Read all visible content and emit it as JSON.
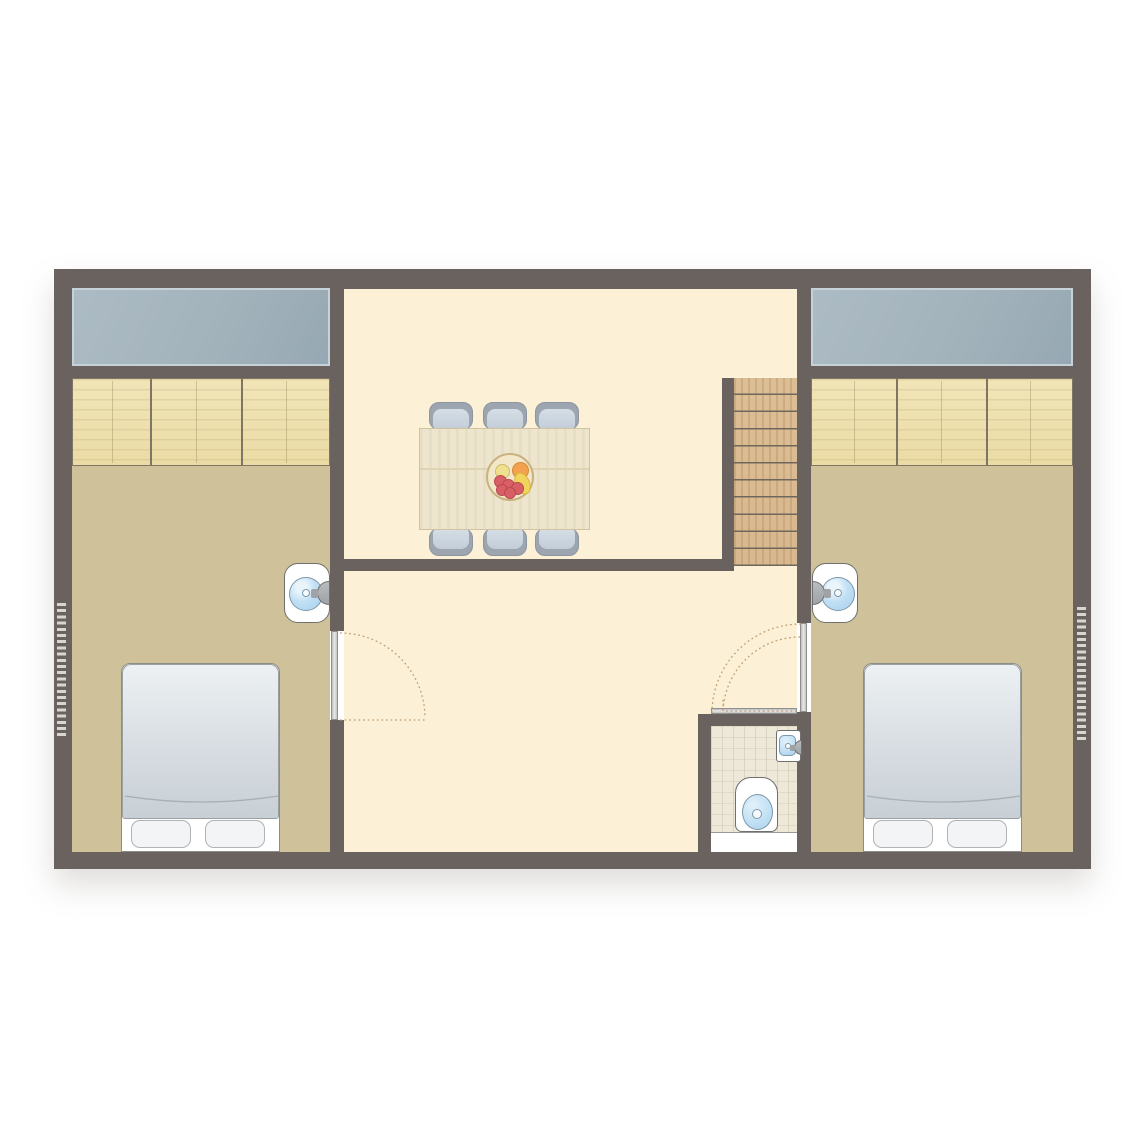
{
  "palette": {
    "pageBg": "#ffffff",
    "wall": "#6A625E",
    "bedroomFloor": "#CFC29B",
    "livingFloor": "#FCF1D6",
    "bathFloor": "#EEE8D8",
    "windowGlass": "#A3B3BC",
    "windowFrame": "#C7D2D8",
    "wood": "#EBDCA6",
    "woodDark": "#7E7565",
    "stairWood": "#D8B88E",
    "stairLine": "#6F675C",
    "tableWood": "#EDE5CD",
    "chairSeat": "#C2CDD8",
    "chairBack": "#9CA5B0",
    "duvetLight": "#EDF1F3",
    "duvetDark": "#C8CFD5",
    "pillow": "#F2F4F5",
    "white": "#FFFFFF",
    "fixtureBlue": "#BFDFF4",
    "fixtureBlueDeep": "#A9D0EC",
    "fixtureBorder": "#7E98A9",
    "outline": "#6F6F6D",
    "arcDots": "#C09E74",
    "radiatorDash": "#D9D6CF",
    "metal": "#9FA3A6",
    "bowlRim": "#C8B27E",
    "bowlFill": "#F2E7C8",
    "fruitRed": "#D95F67",
    "fruitRedEdge": "#B94850",
    "fruitOrange": "#F2A24E",
    "fruitYellow": "#F0D45C",
    "fruitPale": "#EFE08F"
  },
  "floorplan": {
    "type": "residential-floor-plan",
    "rooms": [
      {
        "name": "bedroom-left",
        "furniture": [
          "roof-window",
          "wardrobe-3-sections",
          "double-bed",
          "two-pillows",
          "wash-basin",
          "radiator"
        ]
      },
      {
        "name": "living-dining",
        "furniture": [
          "dining-table",
          "six-chairs",
          "fruit-bowl",
          "staircase-11-treads"
        ]
      },
      {
        "name": "hallway",
        "furniture": [
          "bedroom-left-door-swing",
          "bedroom-right-door-swing",
          "bathroom-door-swing"
        ]
      },
      {
        "name": "bathroom",
        "furniture": [
          "toilet",
          "wall-basin",
          "shower-tray"
        ]
      },
      {
        "name": "bedroom-right",
        "furniture": [
          "roof-window",
          "wardrobe-3-sections",
          "double-bed",
          "two-pillows",
          "wash-basin",
          "radiator"
        ]
      }
    ]
  }
}
